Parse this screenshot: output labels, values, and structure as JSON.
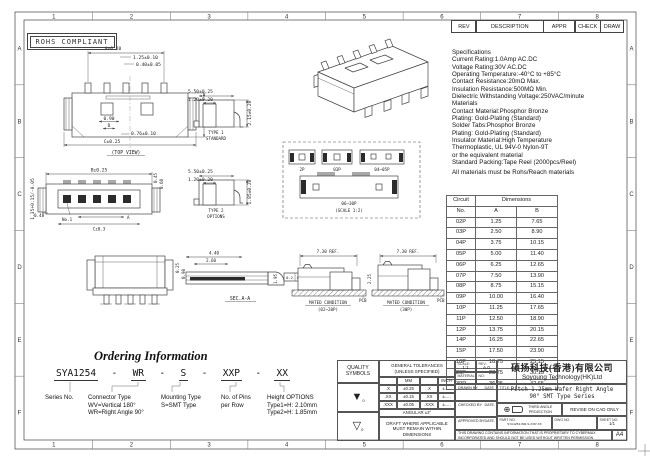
{
  "border": {
    "cols": [
      "1",
      "2",
      "3",
      "4",
      "5",
      "6",
      "7",
      "8"
    ],
    "rows": [
      "A",
      "B",
      "C",
      "D",
      "E",
      "F"
    ]
  },
  "rohs_label": "ROHS COMPLIANT",
  "rev_header": {
    "rev": "REV",
    "description": "DESCRIPTION",
    "appr": "APPR",
    "check": "CHECK",
    "draw": "DRAW"
  },
  "specs": {
    "lines": [
      "Specifications",
      "Current Rating:1.0Amp AC.DC",
      "Voltage Rating:30V AC.DC",
      "Operating Temperature:-40°C to +85°C",
      "Contact Resistance:20mΩ Max.",
      "Insulation Resistance:500MΩ Min.",
      "Dielectric Withstanding Voltage:250VAC/minute",
      "Materials",
      "Contact Material:Phosphor Bronze",
      "Plating: Gold-Plating (Standard)",
      "Solder Tabs:Phosphor Bronze",
      "Plating: Gold-Plating (Standard)",
      "Insulator Material:High Temperature",
      "Thermoplastic, UL 94V-0 Nylon-9T",
      "or the equivalent material",
      "Standard Packing:Tape Reel (2000pcs/Reel)",
      "All materials must be Rohs/Reach materials"
    ]
  },
  "dim_table": {
    "h_circuit": "Circuit",
    "h_no": "No.",
    "h_dimensions": "Dimensions",
    "h_a": "A",
    "h_b": "B",
    "rows": [
      [
        "02P",
        "1.25",
        "7.65"
      ],
      [
        "03P",
        "2.50",
        "8.90"
      ],
      [
        "04P",
        "3.75",
        "10.15"
      ],
      [
        "05P",
        "5.00",
        "11.40"
      ],
      [
        "06P",
        "6.25",
        "12.65"
      ],
      [
        "07P",
        "7.50",
        "13.90"
      ],
      [
        "08P",
        "8.75",
        "15.15"
      ],
      [
        "09P",
        "10.00",
        "16.40"
      ],
      [
        "10P",
        "11.25",
        "17.65"
      ],
      [
        "11P",
        "12.50",
        "18.90"
      ],
      [
        "12P",
        "13.75",
        "20.15"
      ],
      [
        "14P",
        "16.25",
        "22.65"
      ],
      [
        "15P",
        "17.50",
        "23.90"
      ],
      [
        "16P",
        "18.75",
        "25.15"
      ],
      [
        "20P",
        "23.75",
        "30.15"
      ],
      [
        "30P",
        "36.25",
        "42.65"
      ]
    ]
  },
  "drawings": {
    "top_view": {
      "dim_a": "A±0.20",
      "dim_pitch": "1.25±0.10",
      "dim_pin": "0.40±0.05",
      "dim_depth": "3.67±0.10",
      "dim_090": "0.90",
      "dim_d": "D",
      "dim_076": "0.76±0.10",
      "dim_c": "C±0.25",
      "label": "(TOP VIEW)"
    },
    "type1": {
      "dim_w": "5.50±0.25",
      "dim_slot": "1.20±0.20",
      "dim_h": "2.15±0.20",
      "name1": "TYPE 1",
      "name2": "STANDARD"
    },
    "type2": {
      "dim_w": "5.50±0.25",
      "dim_slot": "1.20±0.20",
      "dim_h": "1.85±0.20",
      "name1": "TYPE 2",
      "name2": "OPTIONS"
    },
    "bottom_view": {
      "dim_h": "1.35+0.15/-0.05",
      "dim_b": "B±0.25",
      "dim_045": "0.45",
      "dim_060": "0.60",
      "dim_048": "0.48",
      "no1": "No.1",
      "dim_a": "A",
      "dim_c": "C±0.3"
    },
    "variants": {
      "p2": "2P",
      "p03": "03P",
      "p0405": "04~05P",
      "p0630": "06~30P",
      "scale": "(SCALE 1:2)"
    },
    "sec": {
      "dim1": "4.40",
      "dim2": "2.60",
      "dim3": "0.25",
      "dim4": "0.98",
      "fcf_a": "0.2",
      "fcf_b": "0.10",
      "label": "SEC.A-A"
    },
    "mated1": {
      "ref": "7.30 REF.",
      "h": "1.95",
      "line1": "MATED CONDITION",
      "line2": "(02~20P)",
      "pcb": "PCB"
    },
    "mated2": {
      "ref": "7.30 REF.",
      "h": "2.25",
      "line1": "MATED CONDITION",
      "line2": "(30P)",
      "pcb": "PCB"
    }
  },
  "ordering": {
    "heading": "Ordering Information",
    "code_parts": [
      "SYA1254",
      "WR",
      "S",
      "XXP",
      "XX"
    ],
    "separator": "-",
    "groups": [
      {
        "lines": [
          "Series No."
        ]
      },
      {
        "lines": [
          "Connector Type",
          "WV=Vertical 180°",
          "WR=Right Angle 90°"
        ]
      },
      {
        "lines": [
          "Mounting Type",
          "S=SMT Type"
        ]
      },
      {
        "lines": [
          "No. of Pins",
          "per Row"
        ]
      },
      {
        "lines": [
          "Height OPTIONS",
          "Type1=H: 2.10mm",
          "Type2=H: 1.85mm"
        ]
      }
    ]
  },
  "title_block": {
    "quality_h1": "QUALITY",
    "quality_h2": "SYMBOLS",
    "sym1": "▼",
    "sym1_sub": "0",
    "sym2": "▽",
    "sym2_sub": "0",
    "tolerances": {
      "h1": "GENERAL TOLERANCES",
      "h2": "(UNLESS SPECIFIED)",
      "mm": "MM",
      "inch": "INCH",
      "rows": [
        [
          ".X",
          "±0.25",
          ".X",
          "±....."
        ],
        [
          ".XX",
          "±0.15",
          ".XX",
          "±....."
        ],
        [
          ".XXX",
          "±0.05",
          ".XXX",
          "±....."
        ]
      ],
      "angular": "ANGULAR ±3°",
      "draft_note": "DRAFT WHERE APPLICABLE MUST REMAIN WITHIN DIMENSIONS"
    },
    "scale_label": "SCALE:",
    "scale_value": "1:1",
    "rev_label": "REV:",
    "rev_value": "A.0",
    "material_label": "MATERIAL:",
    "no_label": "NO:",
    "drawn": "DRAWN BY",
    "checked": "CHECKED BY",
    "approved": "APPROVED BY",
    "date": "DATE",
    "company_cn": "硕扬科技(香港)有限公司",
    "company_en": "Soyoung Technology(HK)Ltd",
    "title_label": "TITLE:",
    "title_line1": "Pitch 1.25mm Wafer Right Angle",
    "title_line2": "90° SMT Type Series",
    "projection": "THIRD ANGLE PROJECTION",
    "projection_icon": "⊕",
    "revise": "REVISE ON CAD ONLY",
    "part_label": "PART NO.",
    "part_value": "SYA1254-WR-S-XXP-XX",
    "dwg_label": "DWG NO.",
    "sheet_label": "SHEET NO.",
    "sheet_value": "1/1",
    "note": "THIS DRAWING CONTAINS INFORMATION THAT IS PROPRIETARY TO CYBERMAX INCORPORATED AND SHOULD NOT BE USED WITHOUT WRITTEN PERMISSION",
    "size": "A4"
  }
}
